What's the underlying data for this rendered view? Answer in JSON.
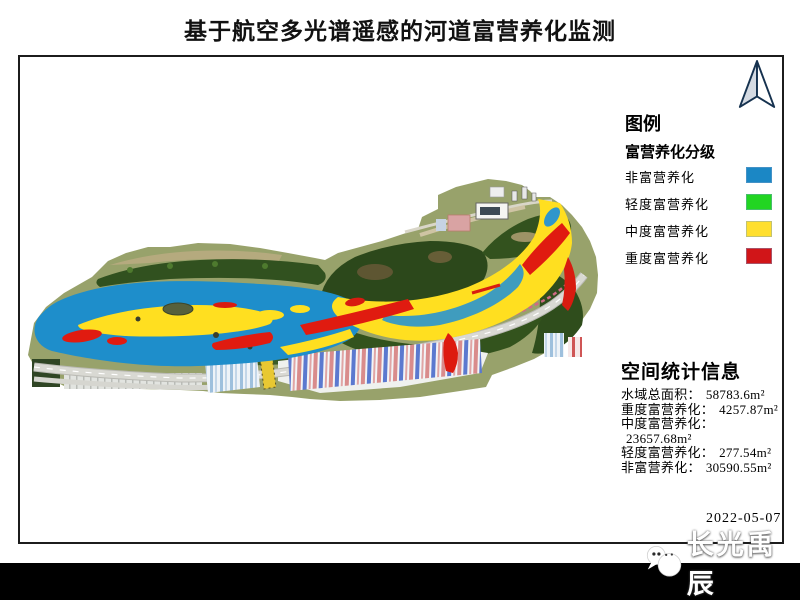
{
  "title": "基于航空多光谱遥感的河道富营养化监测",
  "legend": {
    "title": "图例",
    "group_title": "富营养化分级",
    "items": [
      {
        "label": "非富营养化",
        "color": "#1b87c5"
      },
      {
        "label": "轻度富营养化",
        "color": "#22d522"
      },
      {
        "label": "中度富营养化",
        "color": "#ffdf2e"
      },
      {
        "label": "重度富营养化",
        "color": "#d11518"
      }
    ]
  },
  "statistics": {
    "title": "空间统计信息",
    "rows": [
      {
        "label": "水域总面积：",
        "value": "58783.6m²"
      },
      {
        "label": "重度富营养化：",
        "value": "4257.87m²"
      },
      {
        "label": "中度富营养化：",
        "value": "23657.68m²"
      },
      {
        "label": "轻度富营养化：",
        "value": "277.54m²"
      },
      {
        "label": "非富营养化：",
        "value": "30590.55m²"
      }
    ]
  },
  "date": "2022-05-07",
  "footer": {
    "brand": "长光禹辰"
  }
}
